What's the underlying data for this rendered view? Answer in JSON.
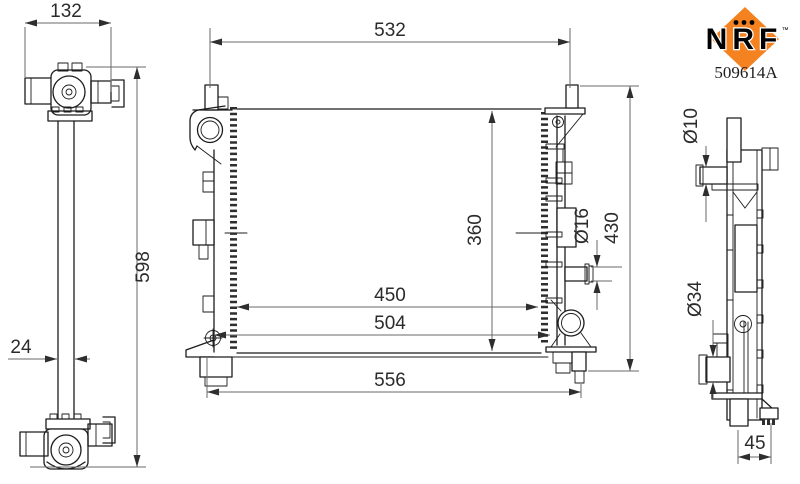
{
  "header": {
    "brand": "NRF",
    "trademark": "™",
    "part_number": "509614A"
  },
  "dimensions": {
    "left_view": {
      "top_width": "132",
      "overall_height": "598",
      "pipe_column_width": "24"
    },
    "front_view": {
      "upper_width": "532",
      "core_height": "360",
      "overall_height": "430",
      "drain_pipe_diameter": "Ø16",
      "mount_width_inner": "450",
      "mount_width_outer": "504",
      "bottom_width": "556"
    },
    "side_view": {
      "small_pipe_diameter": "Ø10",
      "large_pipe_diameter": "Ø34",
      "foot_offset": "45"
    }
  },
  "colors": {
    "brand_orange": "#F58220",
    "line_dark": "#1c1c1c",
    "dimension_gray": "#6a6a6a"
  }
}
